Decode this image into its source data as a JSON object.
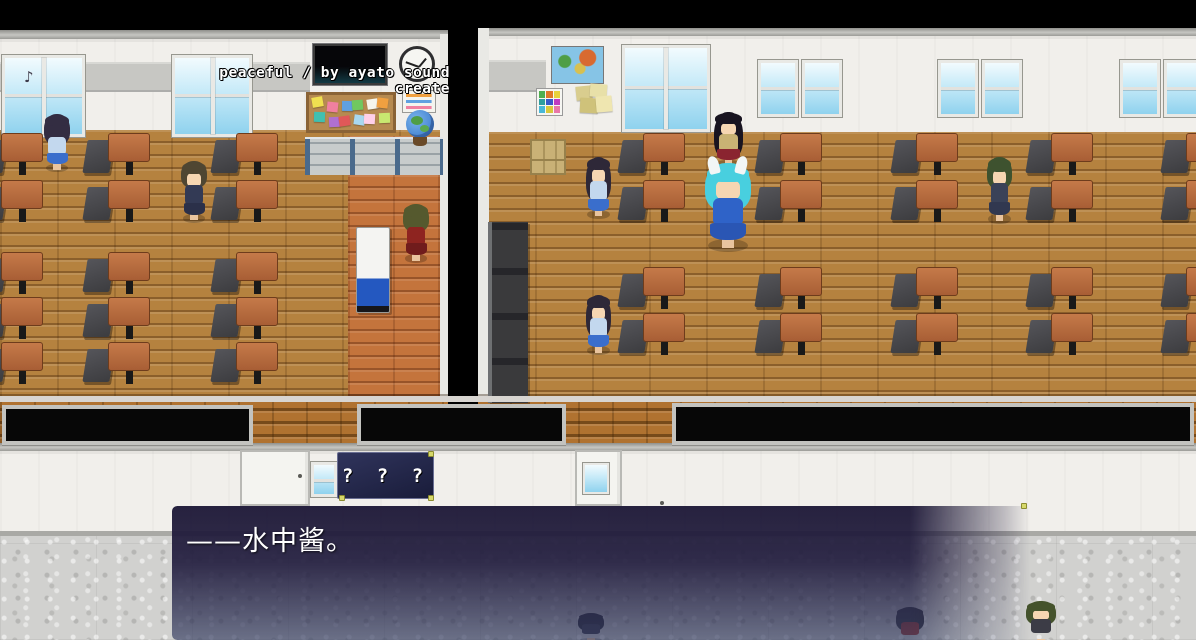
{
  "hud": {
    "music_credit": "peaceful / by ayato sound create",
    "music_note_icon": "♪"
  },
  "signs": {
    "classroom_plaque": "? ? ?"
  },
  "dialogue": {
    "text": "——水中酱。"
  },
  "palette": {
    "dialog_top": "#1d1837",
    "dialog_bottom": "#3a4262",
    "floor_wood": "#b5823f",
    "corridor_wood": "#c4743c",
    "wall_white": "#f1efeb",
    "hall_floor": "#d1d1cf",
    "brick": "#b07230",
    "pin_accent": "#d6d86a",
    "desk_top": "#b5663c",
    "chair_gray": "#474749",
    "note_colors": [
      "#f0e050",
      "#f080a0",
      "#60a0e0",
      "#70c860",
      "#f6f6ec",
      "#f0a040",
      "#40c0b0",
      "#b070d0",
      "#e05858",
      "#a8d8f0",
      "#ffd0e8",
      "#c8e870"
    ]
  },
  "scene": {
    "windows": {
      "classroom_left": [
        {
          "x": 2,
          "y": 55,
          "w": 83,
          "h": 82,
          "panes": 2
        },
        {
          "x": 172,
          "y": 55,
          "w": 80,
          "h": 82,
          "panes": 2
        }
      ],
      "classroom_right": [
        {
          "x": 622,
          "y": 45,
          "w": 88,
          "h": 87,
          "panes": 2
        },
        {
          "x": 758,
          "y": 60,
          "w": 40,
          "h": 57,
          "panes": 1
        },
        {
          "x": 802,
          "y": 60,
          "w": 40,
          "h": 57,
          "panes": 1
        },
        {
          "x": 938,
          "y": 60,
          "w": 40,
          "h": 57,
          "panes": 1
        },
        {
          "x": 982,
          "y": 60,
          "w": 40,
          "h": 57,
          "panes": 1
        },
        {
          "x": 1120,
          "y": 60,
          "w": 40,
          "h": 57,
          "panes": 1
        },
        {
          "x": 1164,
          "y": 60,
          "w": 36,
          "h": 57,
          "panes": 1
        }
      ],
      "hallway": [
        {
          "x": 311,
          "y": 462,
          "w": 26,
          "h": 35,
          "panes": 1
        }
      ]
    },
    "desks": {
      "left": {
        "cols": [
          -22,
          85,
          213
        ],
        "rows": [
          133,
          180,
          252,
          297,
          342
        ]
      },
      "right": {
        "cols": [
          620,
          757,
          893,
          1028,
          1163
        ],
        "rows": [
          133,
          180,
          267,
          313
        ]
      }
    },
    "hall_doors": [
      {
        "x": 240,
        "y": 450,
        "w": 70,
        "h": 56,
        "window": false
      },
      {
        "x": 575,
        "y": 450,
        "w": 47,
        "h": 56,
        "window": true
      }
    ],
    "notice_panels": [
      {
        "x": 2,
        "y": 405,
        "w": 251,
        "h": 40
      },
      {
        "x": 357,
        "y": 404,
        "w": 209,
        "h": 41
      },
      {
        "x": 672,
        "y": 403,
        "w": 522,
        "h": 42
      }
    ],
    "characters": [
      {
        "name": "schoolgirl-left-room",
        "x": 42,
        "y": 112,
        "w": 30,
        "h": 60,
        "hair": "#332d42",
        "hairLen": 52,
        "face": false,
        "outfit": "#c3d8ee",
        "skirt": "#3a6ecc"
      },
      {
        "name": "teacher-suit",
        "x": 179,
        "y": 159,
        "w": 30,
        "h": 64,
        "hair": "#4f4632",
        "hairLen": 42,
        "face": true,
        "outfit": "#333a55",
        "skirt": "#2b3049"
      },
      {
        "name": "teacher-red-tracksuit",
        "x": 401,
        "y": 202,
        "w": 30,
        "h": 61,
        "hair": "#55592e",
        "hairLen": 46,
        "face": false,
        "outfit": "#8e2420",
        "skirt": "#701c1c"
      },
      {
        "name": "schoolgirl-right-room-1",
        "x": 584,
        "y": 155,
        "w": 29,
        "h": 64,
        "hair": "#2e2838",
        "hairLen": 70,
        "face": true,
        "outfit": "#c3d8ee",
        "skirt": "#3a6ecc"
      },
      {
        "name": "long-haired-girl-vest",
        "x": 712,
        "y": 110,
        "w": 33,
        "h": 58,
        "hair": "#191420",
        "hairLen": 82,
        "face": true,
        "outfit": "#c9b274",
        "skirt": "#8a2430"
      },
      {
        "name": "aqua-haired-girl",
        "x": 702,
        "y": 160,
        "w": 52,
        "h": 92,
        "hair": "#48cfdf",
        "hairLen": 52,
        "face": true,
        "outfit": "#2f63c8",
        "skirt": "#2a56b4",
        "horns": true
      },
      {
        "name": "schoolgirl-right-room-2",
        "x": 584,
        "y": 293,
        "w": 29,
        "h": 62,
        "hair": "#2e2838",
        "hairLen": 70,
        "face": true,
        "outfit": "#c3d8ee",
        "skirt": "#3a6ecc"
      },
      {
        "name": "green-haired-student",
        "x": 985,
        "y": 155,
        "w": 29,
        "h": 69,
        "hair": "#3e522f",
        "hairLen": 46,
        "face": true,
        "outfit": "#3a4258",
        "skirt": "#313850"
      },
      {
        "name": "hallway-student-red",
        "x": 894,
        "y": 606,
        "w": 32,
        "h": 40,
        "hair": "#2c2c34",
        "hairLen": 60,
        "face": false,
        "outfit": "#a03028"
      },
      {
        "name": "hallway-student-green",
        "x": 1024,
        "y": 600,
        "w": 34,
        "h": 46,
        "hair": "#45532c",
        "hairLen": 52,
        "face": true,
        "outfit": "#3c3c46"
      },
      {
        "name": "hallway-student-dim",
        "x": 576,
        "y": 612,
        "w": 30,
        "h": 30,
        "hair": "#20202c",
        "hairLen": 60,
        "face": false,
        "outfit": "#303040"
      }
    ]
  }
}
